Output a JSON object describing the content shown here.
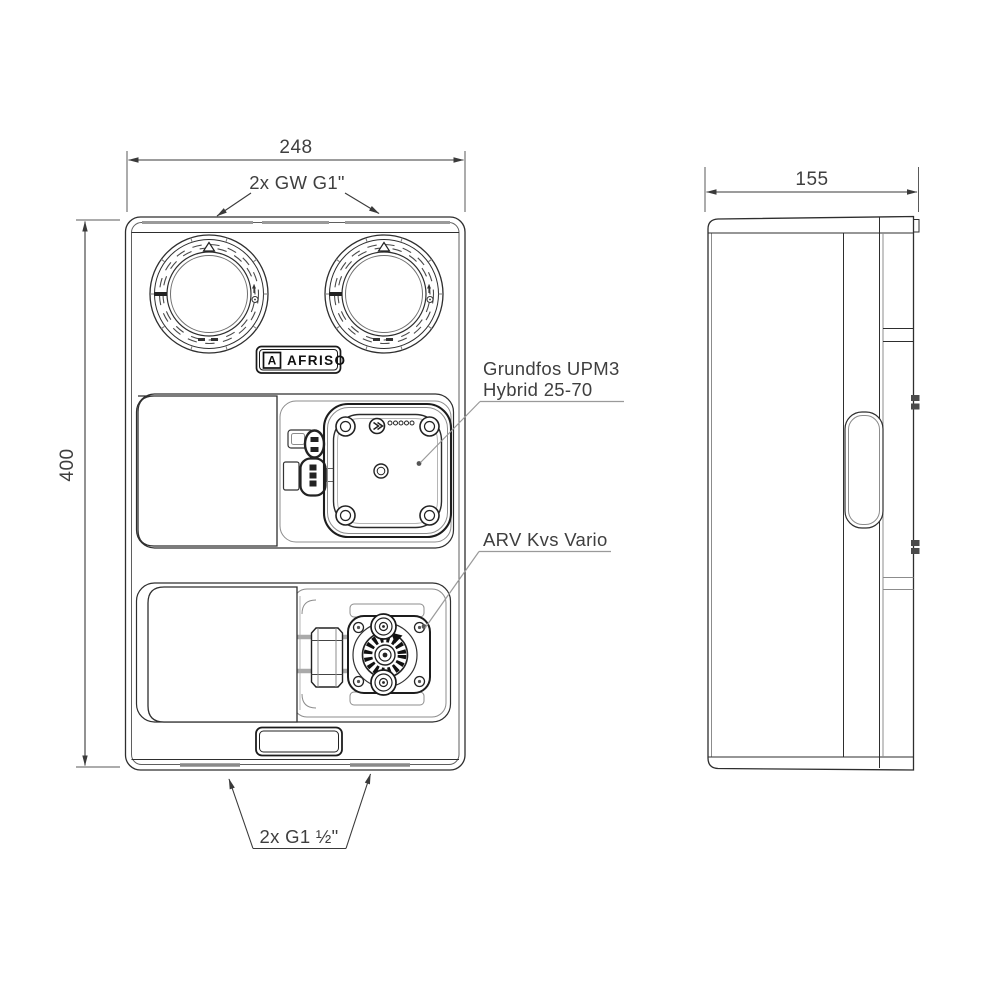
{
  "drawing": {
    "dimensions": {
      "front_width": "248",
      "depth": "155",
      "height": "400"
    },
    "callouts": {
      "top_connections": "2x GW G1\"",
      "bottom_connections": "2x G1 ½\"",
      "pump_line1": "Grundfos UPM3",
      "pump_line2": "Hybrid 25-70",
      "valve": "ARV Kvs Vario"
    },
    "brand": {
      "mark": "A",
      "name": "AFRISO"
    },
    "colors": {
      "line": "#2e2e2e",
      "secondary_line": "#8c8c8c",
      "leader": "#9a9a9a",
      "text": "#3f3f3f",
      "background": "#ffffff"
    }
  }
}
